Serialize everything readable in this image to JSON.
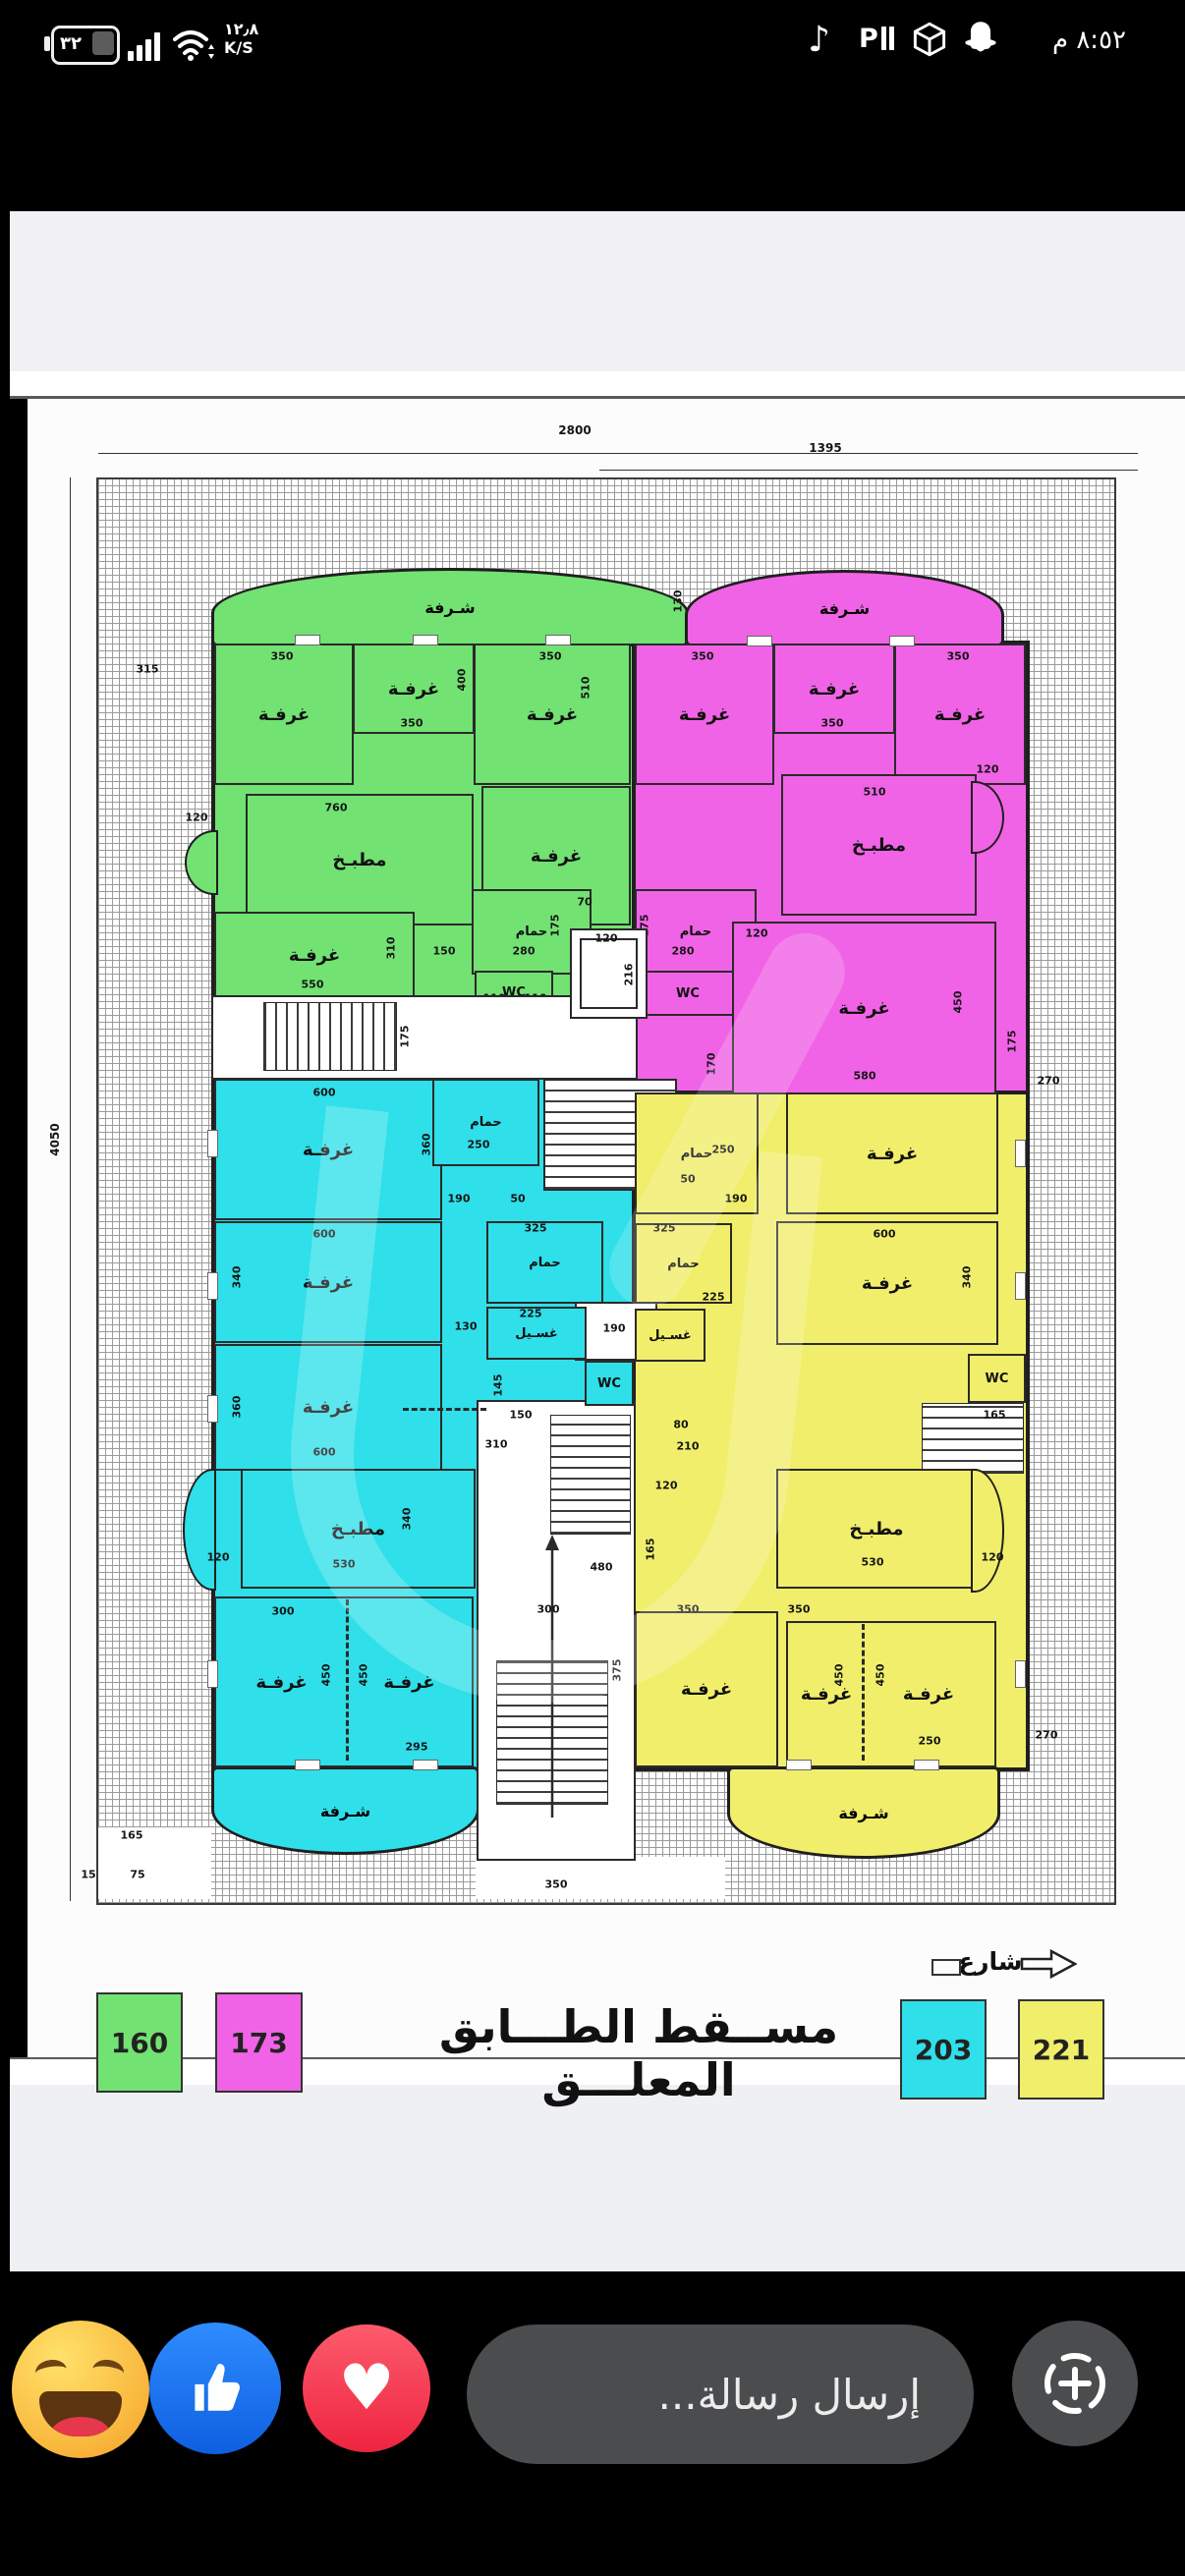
{
  "status_bar": {
    "battery_percent": "٣٢",
    "net_speed_value": "١٢٫٨",
    "net_speed_unit": "K/S",
    "time": "٨:٥٢ م",
    "icon_names": [
      "battery",
      "signal",
      "wifi",
      "tiktok",
      "video-player",
      "cube",
      "snapchat"
    ]
  },
  "plan": {
    "title": "مســقط الطـــابق المعلـــق",
    "street_label": "شارع",
    "labels": {
      "room": "غرفـة",
      "kitchen": "مطبـخ",
      "bath": "حمام",
      "balcony": "شـرفة",
      "wc": "WC",
      "laundry": "غسـيل"
    },
    "legend": [
      {
        "value": "160",
        "color": "#72e272"
      },
      {
        "value": "173",
        "color": "#f163e6"
      },
      {
        "value": "203",
        "color": "#2fdfe9"
      },
      {
        "value": "221",
        "color": "#f1ee6b"
      }
    ],
    "dims": {
      "15": "15",
      "50": "50",
      "70": "70",
      "75": "75",
      "80": "80",
      "110": "110",
      "120": "120",
      "130": "130",
      "145": "145",
      "150": "150",
      "165": "165",
      "170": "170",
      "175": "175",
      "190": "190",
      "210": "210",
      "216": "216",
      "225": "225",
      "250": "250",
      "270": "270",
      "280": "280",
      "295": "295",
      "300": "300",
      "310": "310",
      "315": "315",
      "325": "325",
      "340": "340",
      "350": "350",
      "360": "360",
      "375": "375",
      "400": "400",
      "450": "450",
      "480": "480",
      "510": "510",
      "530": "530",
      "550": "550",
      "580": "580",
      "600": "600",
      "760": "760",
      "1395": "1395",
      "2800": "2800",
      "4050": "4050"
    }
  },
  "composer": {
    "placeholder": "إرسال رسالة...",
    "reactions": [
      "laugh",
      "like",
      "love"
    ],
    "colors": {
      "like_blue": "#1877f2",
      "love_red": "#f0284a",
      "pill_gray": "#4a4c4e"
    }
  }
}
